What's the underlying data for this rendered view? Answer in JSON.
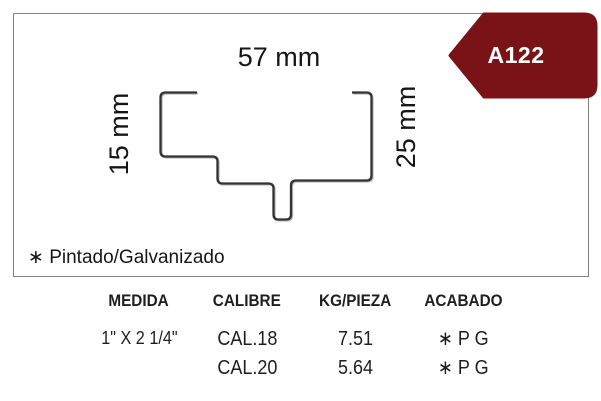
{
  "badge": {
    "label": "A122",
    "color": "#7a1317",
    "text_color": "#ffffff"
  },
  "diagram": {
    "dim_top": "57 mm",
    "dim_left": "15 mm",
    "dim_right": "25 mm",
    "note": "∗ Pintado/Galvanizado"
  },
  "table": {
    "headers": [
      "MEDIDA",
      "CALIBRE",
      "KG/PIEZA",
      "ACABADO"
    ],
    "rows": [
      {
        "medida": "1\" X 2 1/4\"",
        "calibre": "CAL.18",
        "kg_pieza": "7.51",
        "acabado": "∗ P G"
      },
      {
        "medida": "",
        "calibre": "CAL.20",
        "kg_pieza": "5.64",
        "acabado": "∗ P G"
      }
    ]
  },
  "colors": {
    "box_border": "#828282",
    "line": "#333333",
    "text": "#1a1a1a"
  }
}
